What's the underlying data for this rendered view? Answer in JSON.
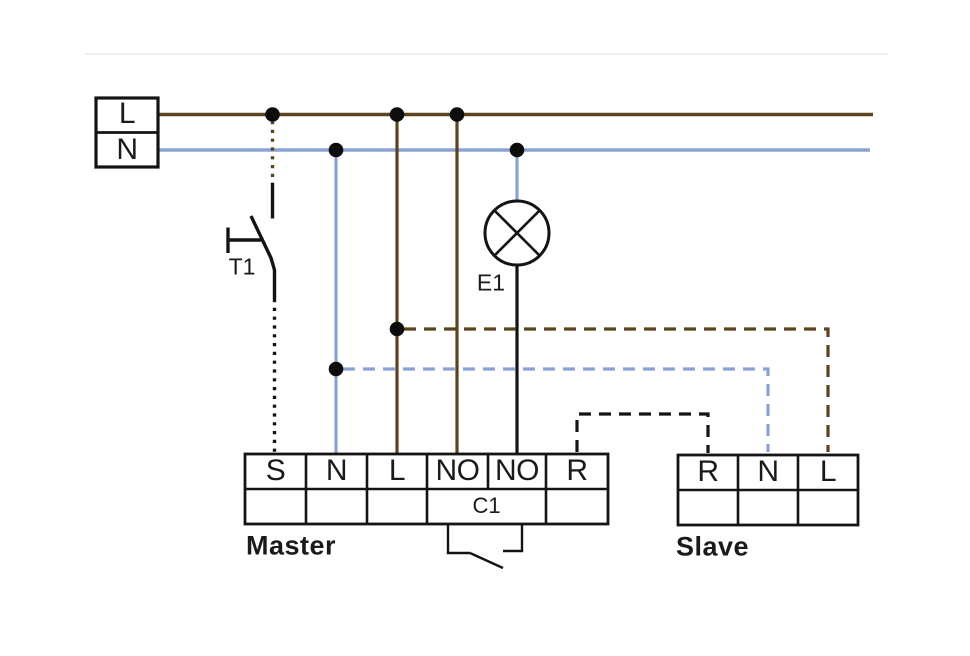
{
  "diagram": {
    "supply": {
      "terminals": [
        "L",
        "N"
      ]
    },
    "pushbutton": {
      "label": "T1"
    },
    "lamp": {
      "label": "E1"
    },
    "master": {
      "label": "Master",
      "terminals": [
        "S",
        "N",
        "L",
        "NO",
        "NO",
        "R"
      ],
      "contact_label": "C1"
    },
    "slave": {
      "label": "Slave",
      "terminals": [
        "R",
        "N",
        "L"
      ]
    },
    "colors": {
      "live_brown": "#5a431e",
      "neutral_blue": "#8ba3d4",
      "wire_black": "#141414"
    }
  }
}
